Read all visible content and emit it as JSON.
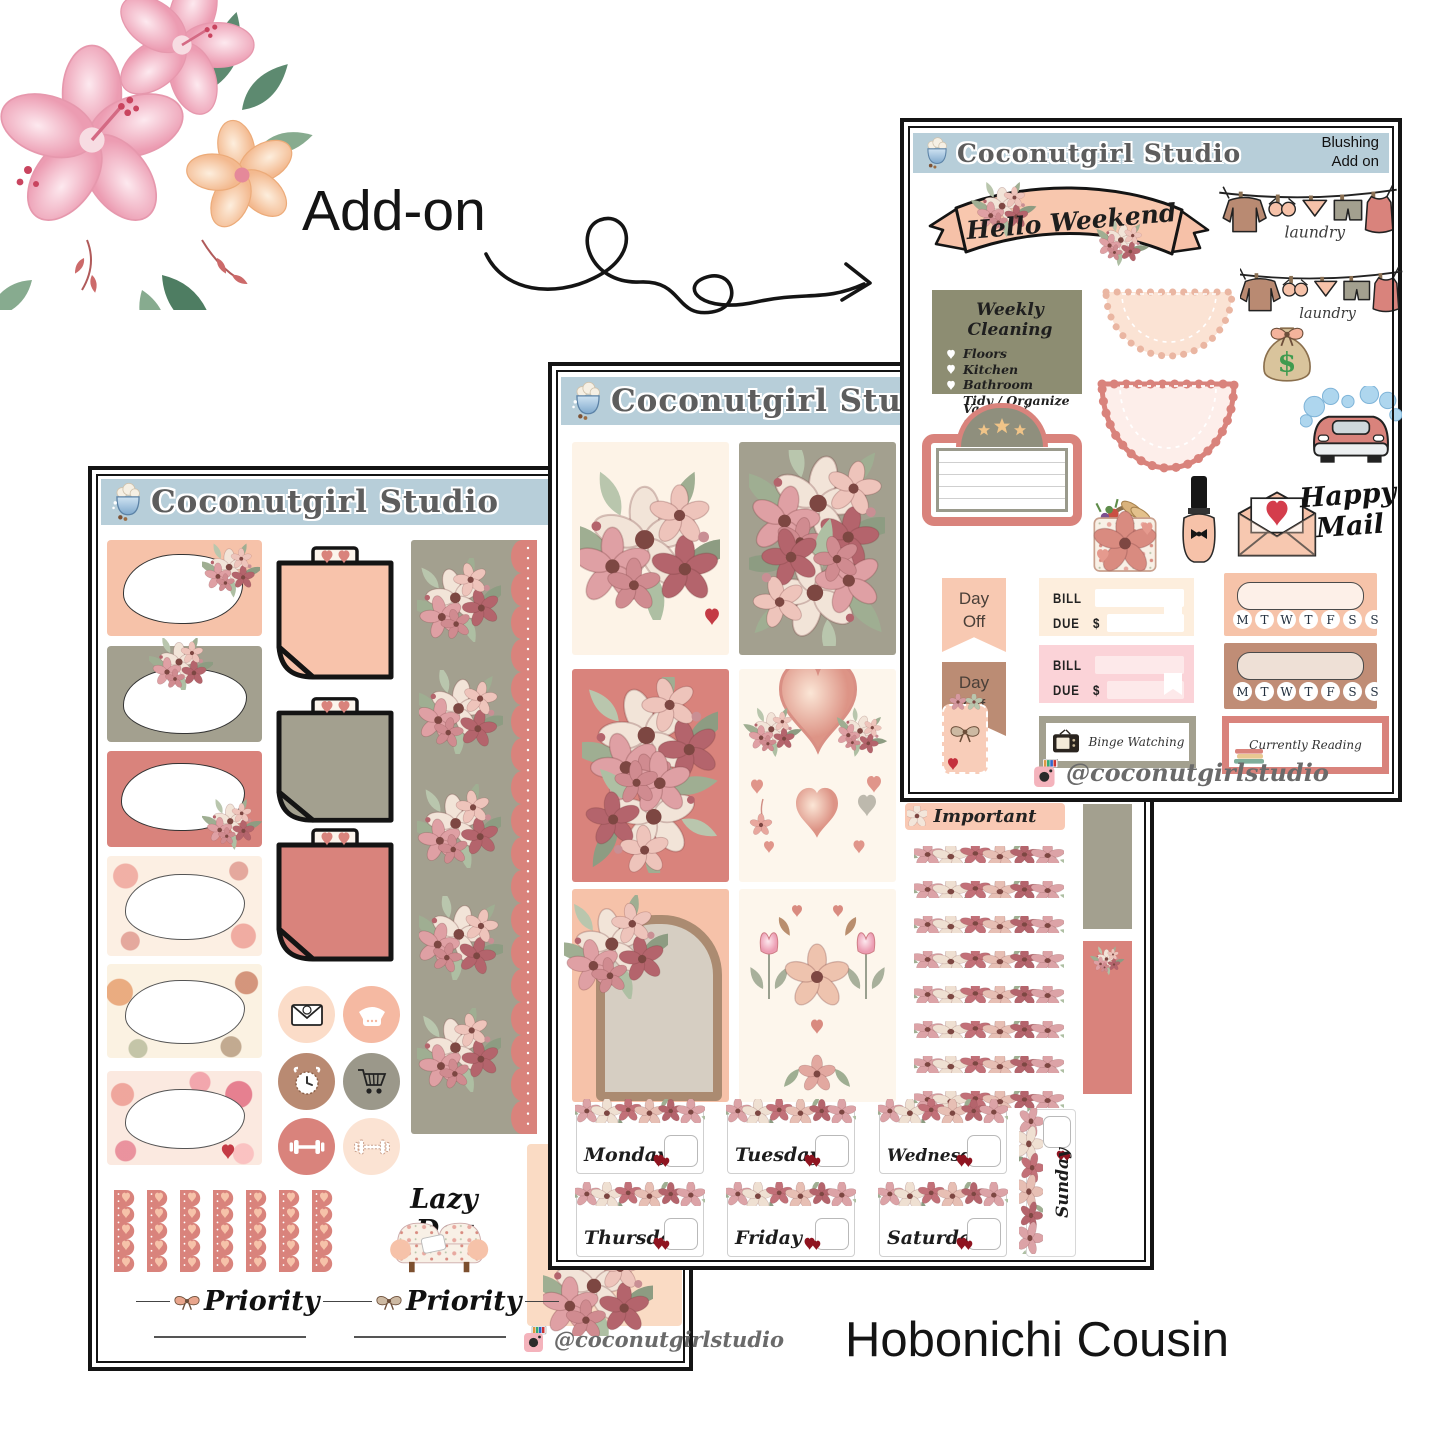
{
  "canvas": {
    "width": 1445,
    "height": 1445
  },
  "decor": {
    "add_on_label": "Add-on",
    "product_label": "Hobonichi Cousin"
  },
  "brand": {
    "name": "Coconutgirl Studio",
    "instagram_handle": "@coconutgirlstudio",
    "variant_line1": "Blushing",
    "variant_line2": "Add on"
  },
  "addon_sheet": {
    "banner_text": "Hello Weekend",
    "laundry_label": "laundry",
    "weekly_cleaning": {
      "title": "Weekly Cleaning",
      "items": [
        "Floors",
        "Kitchen",
        "Bathroom",
        "Tidy / Organize",
        "Vacuum / Sweep"
      ]
    },
    "day_off_line1": "Day",
    "day_off_line2": "Off",
    "bill": {
      "label1": "BILL",
      "label2": "DUE",
      "currency": "$"
    },
    "week_letters": [
      "M",
      "T",
      "W",
      "T",
      "F",
      "S",
      "S"
    ],
    "binge_watching_label": "Binge Watching",
    "currently_reading_label": "Currently Reading",
    "happy_mail_line1": "Happy",
    "happy_mail_line2": "Mail"
  },
  "weekly_sheet": {
    "important_label": "Important",
    "days": [
      "Monday",
      "Tuesday",
      "Wednesday",
      "Thursday",
      "Friday",
      "Saturday"
    ],
    "sunday_label": "Sunday"
  },
  "left_sheet": {
    "lazy_day_label": "Lazy Day",
    "priority_label": "Priority"
  },
  "palette": {
    "header_blue": "#b7ced9",
    "peach": "#f6c2a9",
    "rose": "#d9837c",
    "olive": "#8d8d72",
    "sage": "#a3a08f",
    "cream": "#fdf3e7",
    "pink": "#fbd3d8",
    "brown": "#bb8c74",
    "heart_red": "#9e1c24"
  }
}
